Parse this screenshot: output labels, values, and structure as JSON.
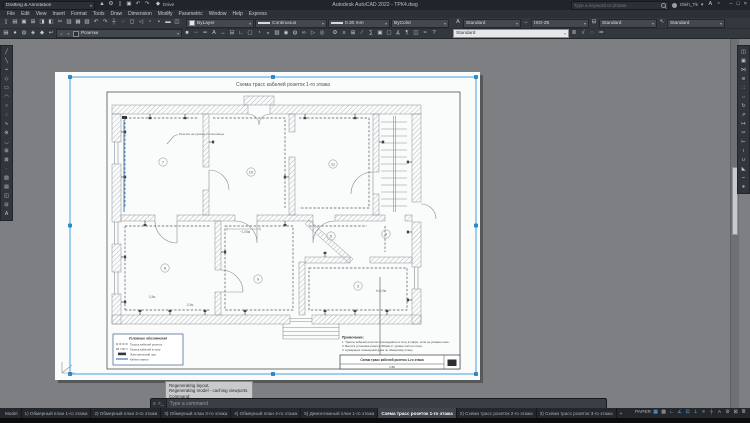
{
  "titlebar": {
    "workspace": "Drafting & Annotation",
    "app_title": "Autodesk AutoCAD 2022 - ТРК4.dwg",
    "search_placeholder": "Type a keyword or phrase",
    "username": "Oleh_Tk",
    "drive": "Drive",
    "qa_icons": [
      {
        "n": "application-menu",
        "g": "▲"
      },
      {
        "n": "gear",
        "g": "⚙"
      },
      {
        "n": "new-drawing",
        "g": "▯"
      },
      {
        "n": "save-quick",
        "g": "▣"
      },
      {
        "n": "undo-quick",
        "g": "↶"
      },
      {
        "n": "redo-quick",
        "g": "↷"
      }
    ],
    "right_icons": [
      {
        "n": "autodesk-account",
        "g": "A"
      },
      {
        "n": "notification",
        "g": "◔"
      }
    ],
    "minimize": "–",
    "maximize": "□",
    "close": "×"
  },
  "menus": {
    "items": [
      "File",
      "Edit",
      "View",
      "Insert",
      "Format",
      "Tools",
      "Draw",
      "Dimension",
      "Modify",
      "Parametric",
      "Window",
      "Help",
      "Express"
    ]
  },
  "toolbar1": {
    "icons": [
      {
        "n": "qnew",
        "g": "▯"
      },
      {
        "n": "open",
        "g": "▤"
      },
      {
        "n": "save",
        "g": "▣"
      },
      {
        "n": "plot",
        "g": "⊞"
      },
      {
        "n": "plot-preview",
        "g": "◨"
      },
      {
        "n": "publish",
        "g": "◧"
      },
      {
        "n": "cut",
        "g": "✂"
      },
      {
        "n": "copy-clip",
        "g": "▥"
      },
      {
        "n": "paste",
        "g": "▦"
      },
      {
        "n": "match-properties",
        "g": "▧"
      },
      {
        "n": "undo",
        "g": "↶"
      },
      {
        "n": "redo",
        "g": "↷"
      },
      {
        "n": "pan",
        "g": "┼"
      },
      {
        "n": "zoom-realtime",
        "g": "◌"
      },
      {
        "n": "zoom-window",
        "g": "◻"
      },
      {
        "n": "zoom-previous",
        "g": "◁"
      },
      {
        "n": "properties",
        "g": "▫"
      },
      {
        "n": "design-center",
        "g": "▪"
      },
      {
        "n": "tool-palettes",
        "g": "▬"
      },
      {
        "n": "sheet-set-manager",
        "g": "◫"
      }
    ],
    "color": "ByLayer",
    "linetype": "Continuous",
    "lineweight": "0.30 mm",
    "plotstyle": "ByColor",
    "textstyle_icon": "A",
    "textstyle": "Standard",
    "dimstyle_icon": "↔",
    "dimstyle": "ISO-25",
    "tablestyle_icon": "⊟",
    "tablestyle": "Standard",
    "mleaderstyle_icon": "↖",
    "mleaderstyle": "Standard"
  },
  "toolbar2": {
    "left_icons": [
      {
        "n": "layer-properties",
        "g": "▤"
      },
      {
        "n": "layer-off",
        "g": "●"
      },
      {
        "n": "layer-freeze",
        "g": "◍"
      },
      {
        "n": "layer-lock",
        "g": "◈"
      },
      {
        "n": "make-object-layer-current",
        "g": "◆"
      },
      {
        "n": "layer-previous",
        "g": "↩"
      }
    ],
    "layer": "Розетки",
    "mid_icons": [
      {
        "n": "color-control",
        "g": "■"
      },
      {
        "n": "linetype-control",
        "g": "┄"
      },
      {
        "n": "lineweight-control",
        "g": "━"
      },
      {
        "n": "text-style",
        "g": "A"
      },
      {
        "n": "dimension-style",
        "g": "↔"
      },
      {
        "n": "table-style",
        "g": "⊟"
      },
      {
        "n": "ucs",
        "g": "∟"
      },
      {
        "n": "named-views",
        "g": "▢"
      },
      {
        "n": "3d-orbit",
        "g": "◔"
      },
      {
        "n": "render",
        "g": "◒"
      },
      {
        "n": "materials",
        "g": "▨"
      },
      {
        "n": "lights",
        "g": "◉"
      },
      {
        "n": "sun-status",
        "g": "◍"
      },
      {
        "n": "walk-fly",
        "g": "∞"
      },
      {
        "n": "show-motion",
        "g": "▷"
      },
      {
        "n": "steering-wheel",
        "g": "◎"
      }
    ],
    "right_icons": [
      {
        "n": "workspaces",
        "g": "⚙"
      },
      {
        "n": "properties-palette",
        "g": "≡"
      },
      {
        "n": "sheet-set",
        "g": "⊞"
      },
      {
        "n": "markup",
        "g": "∕"
      },
      {
        "n": "quick-calc",
        "g": "∑"
      },
      {
        "n": "group",
        "g": "▣"
      },
      {
        "n": "ungroup",
        "g": "▢"
      },
      {
        "n": "measure",
        "g": "∡"
      },
      {
        "n": "annotate",
        "g": "¶"
      },
      {
        "n": "viewports",
        "g": "◫"
      },
      {
        "n": "view-manager",
        "g": "≈"
      },
      {
        "n": "help",
        "g": "?"
      }
    ],
    "light_combo": "Standard",
    "tail_icons": [
      {
        "n": "text-align",
        "g": "≣"
      },
      {
        "n": "spell-check",
        "g": "√"
      },
      {
        "n": "find",
        "g": "◌"
      },
      {
        "n": "options",
        "g": "≔"
      }
    ]
  },
  "tools_left": {
    "icons": [
      {
        "n": "line",
        "g": "╱"
      },
      {
        "n": "construction-line",
        "g": "╲"
      },
      {
        "n": "polyline",
        "g": "┉"
      },
      {
        "n": "polygon",
        "g": "◇"
      },
      {
        "n": "rectangle",
        "g": "▭"
      },
      {
        "n": "arc",
        "g": "◠"
      },
      {
        "n": "circle",
        "g": "○"
      },
      {
        "n": "revision-cloud",
        "g": "◌"
      },
      {
        "n": "spline",
        "g": "∿"
      },
      {
        "n": "ellipse",
        "g": "⊜"
      },
      {
        "n": "ellipse-arc",
        "g": "◡"
      },
      {
        "n": "insert-block",
        "g": "⊞"
      },
      {
        "n": "make-block",
        "g": "⊠"
      },
      {
        "n": "point",
        "g": "∙"
      },
      {
        "n": "hatch",
        "g": "▨"
      },
      {
        "n": "gradient",
        "g": "▤"
      },
      {
        "n": "region",
        "g": "◱"
      },
      {
        "n": "table",
        "g": "⊟"
      },
      {
        "n": "multiline-text",
        "g": "A"
      }
    ]
  },
  "tools_right": {
    "icons": [
      {
        "n": "erase",
        "g": "◫"
      },
      {
        "n": "copy",
        "g": "▣"
      },
      {
        "n": "mirror",
        "g": "⋈"
      },
      {
        "n": "offset",
        "g": "≋"
      },
      {
        "n": "array",
        "g": "∷"
      },
      {
        "n": "move",
        "g": "⇔"
      },
      {
        "n": "rotate",
        "g": "↻"
      },
      {
        "n": "scale",
        "g": "⇗"
      },
      {
        "n": "stretch",
        "g": "↦"
      },
      {
        "n": "trim",
        "g": "✂"
      },
      {
        "n": "extend",
        "g": "⊢"
      },
      {
        "n": "break",
        "g": "≀"
      },
      {
        "n": "join",
        "g": "∪"
      },
      {
        "n": "chamfer",
        "g": "◣"
      },
      {
        "n": "fillet",
        "g": "⌣"
      },
      {
        "n": "explode",
        "g": "∗"
      }
    ]
  },
  "command": {
    "customize_icon": "≡",
    "prompt_icon": ">_",
    "prompt": "Type a command",
    "history1": "Regenerating layout.",
    "history2": "Regenerating model - caching viewports.",
    "history3": "Command:"
  },
  "tabs": {
    "items": [
      {
        "label": "Model"
      },
      {
        "label": "1) Обмерный план 1-го этажа"
      },
      {
        "label": "2) Обмерный план 2-го этажа"
      },
      {
        "label": "3) Обмерный план 3-го этажа"
      },
      {
        "label": "4) Обмерный план 4-го этажа"
      },
      {
        "label": "5) Демонтажный план 1-го этажа"
      },
      {
        "label": "Схема трасс розеток 1-го этажа",
        "active": true
      },
      {
        "label": "2) Схема трасс розеток 2-го этажа"
      },
      {
        "label": "3) Схема трасс розеток 3-го этажа"
      },
      {
        "label": "+",
        "add": true
      }
    ]
  },
  "status": {
    "icons": [
      {
        "n": "paper-space",
        "g": "PAPER"
      },
      {
        "n": "grid-display",
        "g": "▦",
        "on": true
      },
      {
        "n": "snap-mode",
        "g": "▩"
      },
      {
        "n": "ortho-mode",
        "g": "∟"
      },
      {
        "n": "polar-tracking",
        "g": "∠",
        "on": true
      },
      {
        "n": "object-snap",
        "g": "⊡",
        "on": true
      },
      {
        "n": "object-snap-tracking",
        "g": "⊥"
      },
      {
        "n": "lineweight-display",
        "g": "≡"
      },
      {
        "n": "dynamic-input",
        "g": "┼",
        "on": true
      },
      {
        "n": "annotation-visibility",
        "g": "A"
      },
      {
        "n": "workspace-switching",
        "g": "⚙"
      },
      {
        "n": "clean-screen",
        "g": "⊠"
      },
      {
        "n": "customization-menu",
        "g": "≣"
      }
    ]
  },
  "plan": {
    "title": "Схема трасс кабелей розеток 1-го этажа",
    "annotation": "Розетки на уровне столешницы",
    "rooms": [
      {
        "n": "7",
        "x": 108,
        "y": 90
      },
      {
        "n": "10",
        "x": 196,
        "y": 100
      },
      {
        "n": "11",
        "x": 278,
        "y": 92
      },
      {
        "n": "5",
        "x": 276,
        "y": 164
      },
      {
        "n": "4",
        "x": 331,
        "y": 162
      },
      {
        "n": "8",
        "x": 110,
        "y": 196
      },
      {
        "n": "9",
        "x": 203,
        "y": 207
      },
      {
        "n": "3",
        "x": 303,
        "y": 214
      }
    ],
    "dims": {
      "d1": "0,3м",
      "d2": "0,3м",
      "d3": "h=0,9м",
      "d4": "~1,05м"
    },
    "legend": {
      "title": "Условные обозначения",
      "items": [
        {
          "label": "Трасса кабелей розеток"
        },
        {
          "label": "Трасса кабелей в полу"
        },
        {
          "label": "Электрический щит"
        },
        {
          "label": "Кабель-канал"
        }
      ]
    },
    "notes": {
      "title": "Примечание:",
      "n1": "1. Трассы кабелей розеток прокладывать в полу в гофре, если не указано иное.",
      "n2": "2. Высота установки розеток 300мм от уровня чистого пола.",
      "n3": "3. Нумерация помещений дана по обмерному плану."
    },
    "stamp": {
      "title": "Схема трасс кабелей розеток 1-го этажа",
      "scale": "1:50"
    }
  }
}
